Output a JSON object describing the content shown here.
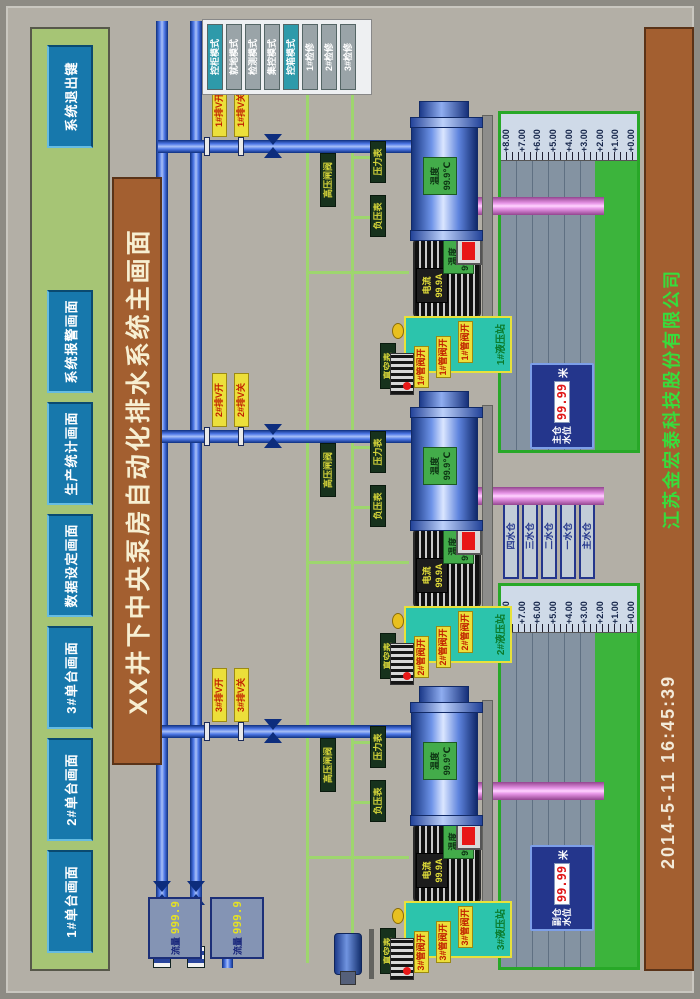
{
  "title": "XX井下中央泵房自动化排水系统主画面",
  "footer": {
    "datetime": "2014-5-11  16:45:39",
    "company": "江苏金宏泰科技股份有限公司"
  },
  "toolbar": {
    "buttons": [
      {
        "label": "1#单台画面"
      },
      {
        "label": "2#单台画面"
      },
      {
        "label": "3#单台画面"
      },
      {
        "label": "数据设定画面"
      },
      {
        "label": "生产统计画面"
      },
      {
        "label": "系统报警画面"
      },
      {
        "label": "系统退出键"
      }
    ]
  },
  "mode_panel": {
    "buttons": [
      {
        "label": "控柜模式",
        "state": "active"
      },
      {
        "label": "就地模式",
        "state": "inactive"
      },
      {
        "label": "检测模式",
        "state": "inactive"
      },
      {
        "label": "集控模式",
        "state": "inactive"
      },
      {
        "label": "控箱模式",
        "state": "active"
      },
      {
        "label": "1#检修",
        "state": "inactive"
      },
      {
        "label": "2#检修",
        "state": "inactive"
      },
      {
        "label": "3#检修",
        "state": "inactive"
      }
    ]
  },
  "flow_meters": [
    {
      "label": "流量",
      "value": "999.9"
    },
    {
      "label": "流量",
      "value": "999.9"
    }
  ],
  "pumps": [
    {
      "id": "3#",
      "valve_open_label": "3#排V开",
      "valve_close_label": "3#排V关",
      "gauges": {
        "hp_valve": "高压闸阀",
        "neg_pressure": "负压表",
        "pressure": "压力表",
        "vacuum": "真空表"
      },
      "pump_temp": {
        "label": "温度",
        "value": "99.9℃"
      },
      "motor_current": {
        "label": "电流",
        "value": "99.9A"
      },
      "motor_temp": {
        "label": "温度",
        "value": "99.9℃"
      },
      "hydraulic": {
        "title": "3#液压站",
        "valve_labels": [
          "3#管阀开",
          "3#管阀开",
          "3#管阀开"
        ]
      }
    },
    {
      "id": "2#",
      "valve_open_label": "2#排V开",
      "valve_close_label": "2#排V关",
      "gauges": {
        "hp_valve": "高压闸阀",
        "neg_pressure": "负压表",
        "pressure": "压力表",
        "vacuum": "真空表"
      },
      "pump_temp": {
        "label": "温度",
        "value": "99.9℃"
      },
      "motor_current": {
        "label": "电流",
        "value": "99.9A"
      },
      "motor_temp": {
        "label": "温度",
        "value": "99.9℃"
      },
      "hydraulic": {
        "title": "2#液压站",
        "valve_labels": [
          "2#管阀开",
          "2#管阀开",
          "2#管阀开"
        ]
      }
    },
    {
      "id": "1#",
      "valve_open_label": "1#排V开",
      "valve_close_label": "1#排V关",
      "gauges": {
        "hp_valve": "高压闸阀",
        "neg_pressure": "负压表",
        "pressure": "压力表",
        "vacuum": "真空表"
      },
      "pump_temp": {
        "label": "温度",
        "value": "99.9℃"
      },
      "motor_current": {
        "label": "电流",
        "value": "99.9A"
      },
      "motor_temp": {
        "label": "温度",
        "value": "99.9℃"
      },
      "hydraulic": {
        "title": "1#液压站",
        "valve_labels": [
          "1#管阀开",
          "1#管阀开",
          "1#管阀开"
        ]
      }
    }
  ],
  "level_scale": [
    "+8.00",
    "+7.00",
    "+6.00",
    "+5.00",
    "+4.00",
    "+3.00",
    "+2.00",
    "+1.00",
    "+0.00"
  ],
  "sumps": [
    {
      "name_line1": "副仓",
      "name_line2": "水位",
      "value": "99.99",
      "unit": "米"
    },
    {
      "name_line1": "主仓",
      "name_line2": "水位",
      "value": "99.99",
      "unit": "米"
    }
  ],
  "sump_buttons": [
    {
      "label": "四水仓"
    },
    {
      "label": "三水仓"
    },
    {
      "label": "二水仓"
    },
    {
      "label": "一水仓"
    },
    {
      "label": "主水仓"
    }
  ]
}
